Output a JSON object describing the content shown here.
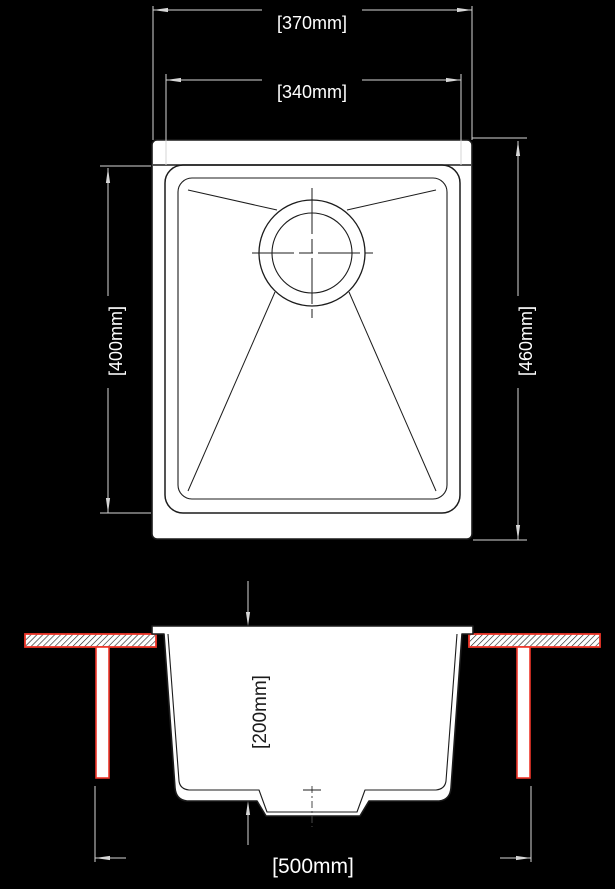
{
  "drawing": {
    "subject": "sink-technical-drawing",
    "views": {
      "plan": {
        "dimensions": [
          {
            "id": "overall-width",
            "label": "[370mm]"
          },
          {
            "id": "bowl-width",
            "label": "[340mm]"
          },
          {
            "id": "bowl-length",
            "label": "[400mm]"
          },
          {
            "id": "overall-length",
            "label": "[460mm]"
          }
        ]
      },
      "section": {
        "dimensions": [
          {
            "id": "bowl-depth",
            "label": "[200mm]"
          },
          {
            "id": "cabinet-width",
            "label": "[500mm]"
          }
        ]
      }
    },
    "colors": {
      "background": "#000000",
      "paper": "#ffffff",
      "ink": "#1c1c1c",
      "dimension_lines": "#d6d6d6",
      "dimension_text": "#ffffff",
      "countertop_red": "#ee3529"
    }
  },
  "labels": {
    "dim_370": "[370mm]",
    "dim_340": "[340mm]",
    "dim_400": "[400mm]",
    "dim_460": "[460mm]",
    "dim_200": "[200mm]",
    "dim_500": "[500mm]"
  }
}
